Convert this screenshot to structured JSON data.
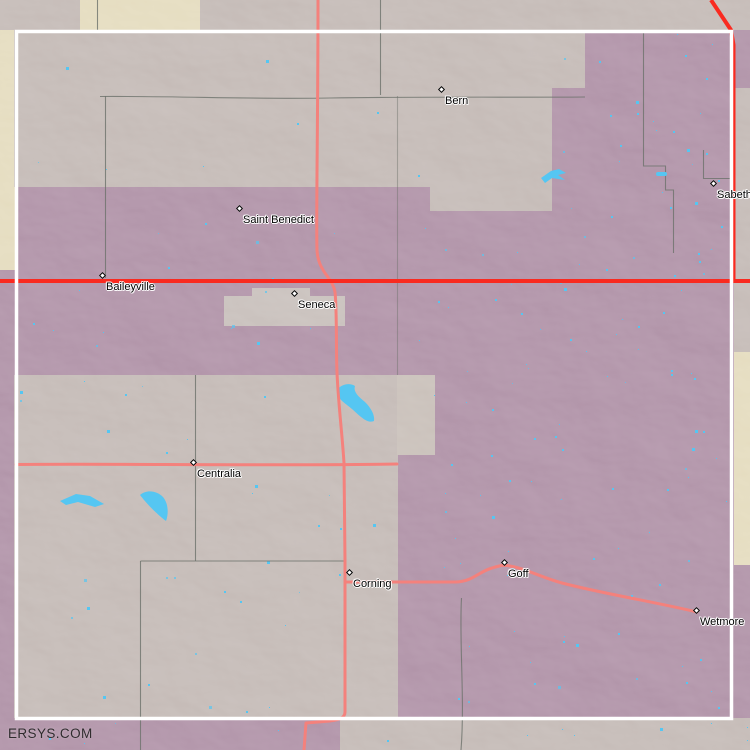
{
  "map": {
    "watermark": "ERSYS.COM",
    "towns": [
      {
        "name": "Bern",
        "x": 442,
        "y": 90
      },
      {
        "name": "Sabetha",
        "x": 714,
        "y": 184
      },
      {
        "name": "Saint Benedict",
        "x": 240,
        "y": 209
      },
      {
        "name": "Baileyville",
        "x": 103,
        "y": 276
      },
      {
        "name": "Seneca",
        "x": 295,
        "y": 294
      },
      {
        "name": "Centralia",
        "x": 194,
        "y": 463
      },
      {
        "name": "Corning",
        "x": 350,
        "y": 573
      },
      {
        "name": "Goff",
        "x": 505,
        "y": 563
      },
      {
        "name": "Wetmore",
        "x": 697,
        "y": 611
      }
    ],
    "colors": {
      "purple": "#9d7b93",
      "gray": "#b5a9a4",
      "gray_light": "#c0b5ac",
      "city_gray": "#bab0ab",
      "beige": "#ddd2ae",
      "water": "#55c6f2",
      "road_minor": "#f4817c",
      "road_major": "#f92a20",
      "boundary": "#6d726b",
      "frame": "#ffffff",
      "label": "#000000",
      "watermark": "#1c1c1c"
    }
  }
}
